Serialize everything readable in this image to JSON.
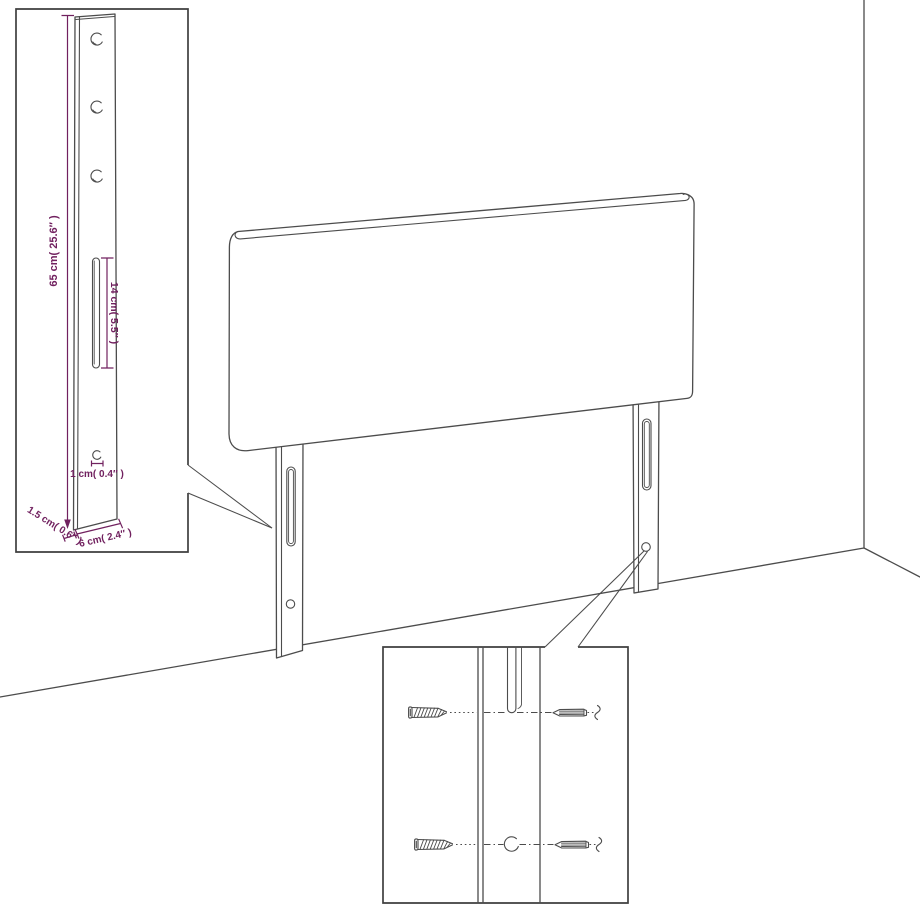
{
  "colors": {
    "background": "#ffffff",
    "line": "#4c4c4c",
    "box": "#3f3f3f",
    "dimension": "#71215f"
  },
  "labels": {
    "leg_height": "65 cm( 25.6″ )",
    "slot_length": "14 cm( 5.5″ )",
    "hole_diameter": "1 cm( 0.4″ )",
    "leg_depth": "1.5 cm( 0.6″ )",
    "leg_width": "6 cm( 2.4″ )"
  }
}
